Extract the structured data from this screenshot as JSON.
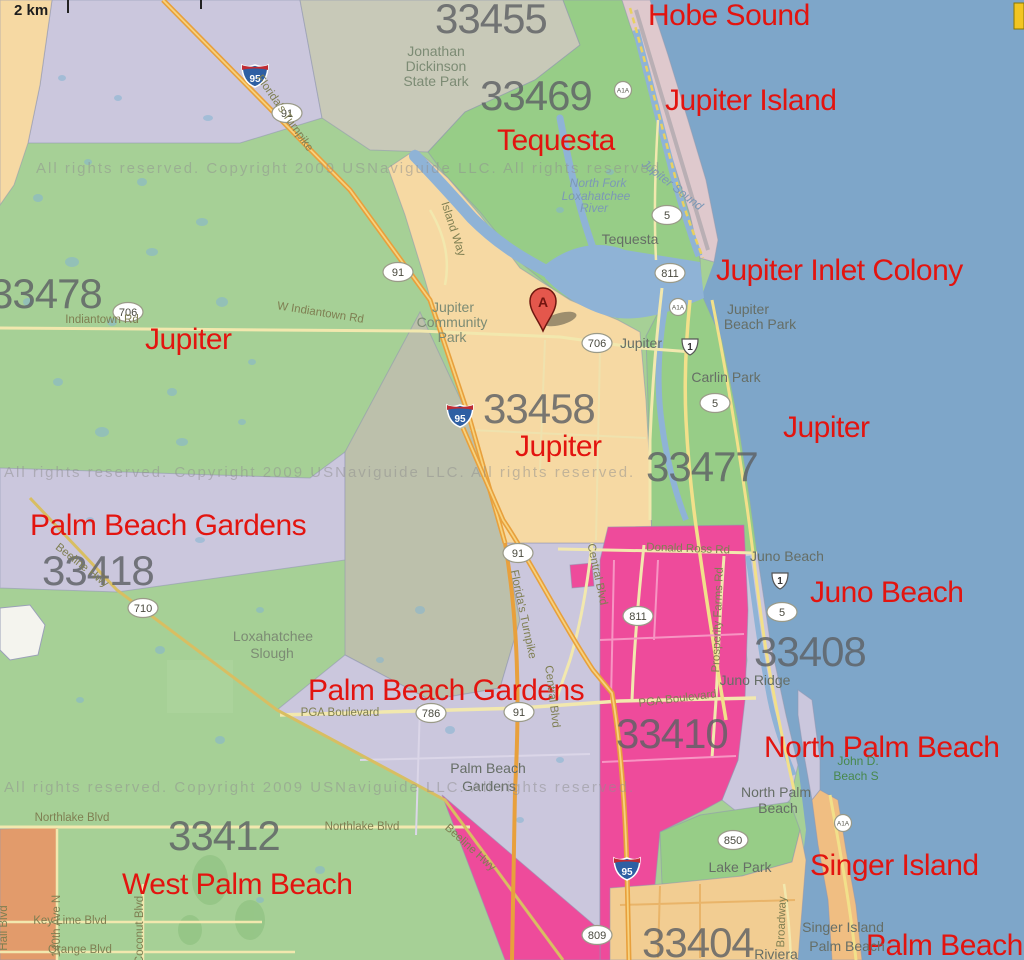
{
  "colors": {
    "ocean": "#7EA6C9",
    "green": "#A6D096",
    "green2": "#97CD87",
    "gray_region": "#C8C9B8",
    "lavender": "#CBC7DD",
    "slough": "#BCC0AB",
    "tan": "#F6D9A3",
    "magenta": "#EE4B9B",
    "acreage": "#E29B6B",
    "barrier": "#DFC9CD",
    "singer": "#F0BE82",
    "khaki": "#F2CD92",
    "water": "#8FB3D6",
    "road_major": "#E8A03C",
    "road_major_core": "#F7D27E",
    "road_minor": "#F2E8AE",
    "red_label": "#E3140F",
    "zip_label": "#5E6165"
  },
  "scale": {
    "label": "2 km"
  },
  "marker": {
    "letter": "A"
  },
  "attribution": "All rights reserved.    Copyright 2009 USNaviguide LLC.   All rights reserved.",
  "city_labels": [
    {
      "text": "Hobe Sound",
      "x": 648,
      "y": 25
    },
    {
      "text": "Jupiter Island",
      "x": 665,
      "y": 110
    },
    {
      "text": "Tequesta",
      "x": 497,
      "y": 150
    },
    {
      "text": "Jupiter Inlet Colony",
      "x": 716,
      "y": 280
    },
    {
      "text": "Jupiter",
      "x": 145,
      "y": 349
    },
    {
      "text": "Jupiter",
      "x": 515,
      "y": 456
    },
    {
      "text": "Jupiter",
      "x": 783,
      "y": 437
    },
    {
      "text": "Palm Beach Gardens",
      "x": 30,
      "y": 535
    },
    {
      "text": "Juno Beach",
      "x": 810,
      "y": 602
    },
    {
      "text": "Palm Beach Gardens",
      "x": 308,
      "y": 700
    },
    {
      "text": "North Palm Beach",
      "x": 764,
      "y": 757
    },
    {
      "text": "Singer Island",
      "x": 810,
      "y": 875
    },
    {
      "text": "West Palm Beach",
      "x": 122,
      "y": 894
    },
    {
      "text": "Palm Beach",
      "x": 866,
      "y": 955
    }
  ],
  "zip_labels": [
    {
      "text": "33455",
      "x": 435,
      "y": 33
    },
    {
      "text": "33469",
      "x": 480,
      "y": 110
    },
    {
      "text": "33478",
      "x": -10,
      "y": 308
    },
    {
      "text": "33458",
      "x": 483,
      "y": 423
    },
    {
      "text": "33477",
      "x": 646,
      "y": 481
    },
    {
      "text": "33418",
      "x": 42,
      "y": 585
    },
    {
      "text": "33408",
      "x": 754,
      "y": 666
    },
    {
      "text": "33410",
      "x": 616,
      "y": 748
    },
    {
      "text": "33412",
      "x": 168,
      "y": 850
    },
    {
      "text": "33404",
      "x": 642,
      "y": 957
    }
  ],
  "place_labels": [
    {
      "text": "Jonathan",
      "x": 436,
      "y": 56,
      "k": "park"
    },
    {
      "text": "Dickinson",
      "x": 436,
      "y": 71,
      "k": "park"
    },
    {
      "text": "State Park",
      "x": 436,
      "y": 86,
      "k": "park"
    },
    {
      "text": "Tequesta",
      "x": 630,
      "y": 244,
      "k": "town"
    },
    {
      "text": "North Fork",
      "x": 598,
      "y": 187,
      "k": "water"
    },
    {
      "text": "Loxahatchee",
      "x": 596,
      "y": 200,
      "k": "water"
    },
    {
      "text": "River",
      "x": 594,
      "y": 212,
      "k": "water"
    },
    {
      "text": "Jupiter Sound",
      "x": 670,
      "y": 188,
      "k": "water",
      "rot": 38
    },
    {
      "text": "Jupiter",
      "x": 453,
      "y": 312,
      "k": "park"
    },
    {
      "text": "Community",
      "x": 452,
      "y": 327,
      "k": "park"
    },
    {
      "text": "Park",
      "x": 452,
      "y": 342,
      "k": "park"
    },
    {
      "text": "Jupiter",
      "x": 641,
      "y": 348,
      "k": "town"
    },
    {
      "text": "Carlin Park",
      "x": 726,
      "y": 382,
      "k": "town"
    },
    {
      "text": "Jupiter",
      "x": 748,
      "y": 314,
      "k": "town"
    },
    {
      "text": "Beach Park",
      "x": 760,
      "y": 329,
      "k": "town"
    },
    {
      "text": "Juno Beach",
      "x": 787,
      "y": 561,
      "k": "town"
    },
    {
      "text": "Juno Ridge",
      "x": 755,
      "y": 685,
      "k": "town"
    },
    {
      "text": "Loxahatchee",
      "x": 273,
      "y": 641,
      "k": "park"
    },
    {
      "text": "Slough",
      "x": 272,
      "y": 658,
      "k": "park"
    },
    {
      "text": "Palm Beach",
      "x": 488,
      "y": 773,
      "k": "town"
    },
    {
      "text": "Gardens",
      "x": 489,
      "y": 791,
      "k": "town"
    },
    {
      "text": "Lake Park",
      "x": 740,
      "y": 872,
      "k": "town"
    },
    {
      "text": "North Palm",
      "x": 776,
      "y": 797,
      "k": "town"
    },
    {
      "text": "Beach",
      "x": 778,
      "y": 813,
      "k": "town"
    },
    {
      "text": "John D.",
      "x": 858,
      "y": 765,
      "k": "park2"
    },
    {
      "text": "Beach S",
      "x": 856,
      "y": 780,
      "k": "park2"
    },
    {
      "text": "Singer Island",
      "x": 843,
      "y": 932,
      "k": "town"
    },
    {
      "text": "Palm Beach",
      "x": 847,
      "y": 951,
      "k": "town"
    },
    {
      "text": "Riviera",
      "x": 776,
      "y": 959,
      "k": "town"
    }
  ],
  "road_labels": [
    {
      "text": "Indiantown Rd",
      "x": 102,
      "y": 323,
      "rot": 0
    },
    {
      "text": "W Indiantown Rd",
      "x": 320,
      "y": 316,
      "rot": 9
    },
    {
      "text": "Northlake Blvd",
      "x": 72,
      "y": 821,
      "rot": 0
    },
    {
      "text": "Northlake Blvd",
      "x": 362,
      "y": 830,
      "rot": 0
    },
    {
      "text": "Donald Ross Rd",
      "x": 688,
      "y": 552,
      "rot": 2
    },
    {
      "text": "PGA Boulevard",
      "x": 340,
      "y": 716,
      "rot": 0
    },
    {
      "text": "PGA Boulevard",
      "x": 678,
      "y": 702,
      "rot": -7
    },
    {
      "text": "Central Blvd",
      "x": 594,
      "y": 575,
      "rot": 78
    },
    {
      "text": "Central Blvd",
      "x": 549,
      "y": 697,
      "rot": 83
    },
    {
      "text": "Prosperity Farms Rd",
      "x": 721,
      "y": 620,
      "rot": -88
    },
    {
      "text": "Florida's Turnpike",
      "x": 520,
      "y": 615,
      "rot": 78
    },
    {
      "text": "Florida's Turnpike",
      "x": 282,
      "y": 115,
      "rot": 55
    },
    {
      "text": "Beeline Hwy",
      "x": 80,
      "y": 568,
      "rot": 38
    },
    {
      "text": "Beeline Hwy",
      "x": 468,
      "y": 850,
      "rot": 42
    },
    {
      "text": "Island Way",
      "x": 450,
      "y": 230,
      "rot": 72
    },
    {
      "text": "Coconut Blvd",
      "x": 143,
      "y": 930,
      "rot": -90
    },
    {
      "text": "140th Ave N",
      "x": 60,
      "y": 926,
      "rot": -90
    },
    {
      "text": "Hall Blvd",
      "x": 7,
      "y": 928,
      "rot": -90
    },
    {
      "text": "Broadway",
      "x": 785,
      "y": 922,
      "rot": -88
    },
    {
      "text": "Key Lime Blvd",
      "x": 70,
      "y": 924,
      "rot": 0
    },
    {
      "text": "Orange Blvd",
      "x": 80,
      "y": 953,
      "rot": 0
    }
  ],
  "shields": {
    "interstate": [
      {
        "label": "95",
        "x": 255,
        "y": 75
      },
      {
        "label": "95",
        "x": 460,
        "y": 415
      },
      {
        "label": "95",
        "x": 627,
        "y": 868
      }
    ],
    "oval": [
      {
        "label": "91",
        "x": 287,
        "y": 113
      },
      {
        "label": "91",
        "x": 398,
        "y": 272
      },
      {
        "label": "91",
        "x": 518,
        "y": 553
      },
      {
        "label": "91",
        "x": 519,
        "y": 712
      },
      {
        "label": "706",
        "x": 128,
        "y": 312
      },
      {
        "label": "706",
        "x": 597,
        "y": 343
      },
      {
        "label": "710",
        "x": 143,
        "y": 608
      },
      {
        "label": "786",
        "x": 431,
        "y": 713
      },
      {
        "label": "811",
        "x": 670,
        "y": 273
      },
      {
        "label": "811",
        "x": 638,
        "y": 616
      },
      {
        "label": "5",
        "x": 667,
        "y": 215
      },
      {
        "label": "5",
        "x": 715,
        "y": 403
      },
      {
        "label": "5",
        "x": 782,
        "y": 612
      },
      {
        "label": "850",
        "x": 733,
        "y": 840
      },
      {
        "label": "809",
        "x": 597,
        "y": 935
      }
    ],
    "us": [
      {
        "label": "1",
        "x": 690,
        "y": 348
      },
      {
        "label": "1",
        "x": 780,
        "y": 582
      }
    ],
    "a1a": [
      {
        "label": "A1A",
        "x": 623,
        "y": 90
      },
      {
        "label": "A1A",
        "x": 678,
        "y": 307
      },
      {
        "label": "A1A",
        "x": 843,
        "y": 823
      }
    ]
  }
}
